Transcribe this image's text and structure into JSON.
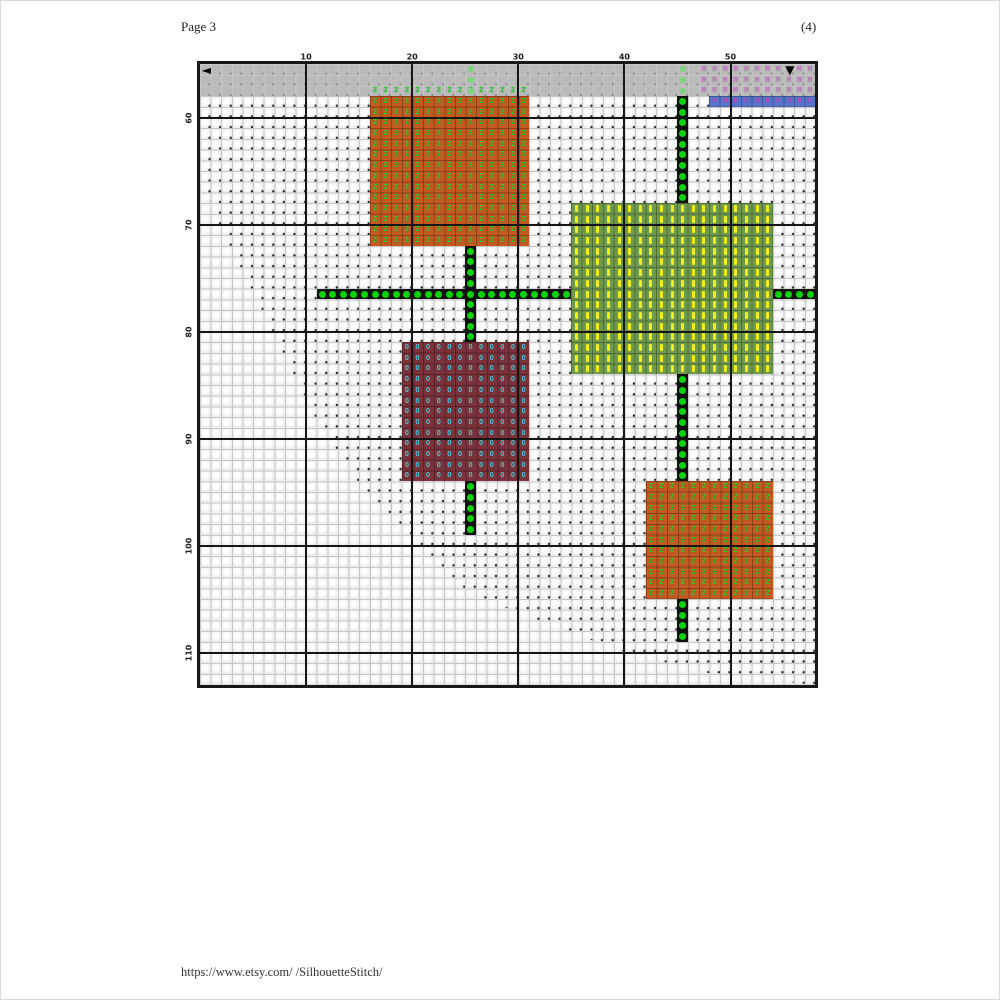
{
  "page": {
    "header_left": "Page 3",
    "header_right": "(4)",
    "footer_url": "https://www.etsy.com/ /SilhouetteStitch/"
  },
  "chart": {
    "type": "cross-stitch-grid",
    "geometry": {
      "x0": 199,
      "y0": 63,
      "cw": 10.61,
      "ch": 10.7,
      "cols": 58,
      "rows": 58
    },
    "colors": {
      "fine_line": "#c6c6c6",
      "heavy_line": "#161616",
      "cell_bg": "#fbfbfb",
      "cell_edge": "#ececec",
      "bg_dot": "#2a2a2a",
      "gray_band": "#bababa",
      "gray_band_dot": "#8d8d8d",
      "green_dot": "#0cd20c",
      "green_dot_bg": "#101010",
      "green_dot_grayed": "#79d879",
      "orange_bg": "#c25a22",
      "orange_symbol": "#2bd02b",
      "yellow_bg": "#6f9a4e",
      "yellow_symbol": "#f0ee1c",
      "maroon_bg": "#7b323a",
      "maroon_symbol": "#55c8d8",
      "blue_band_bg": "#5575cd",
      "magenta_symbol": "#c44fc4",
      "pink_symbol": "#d077d0",
      "block_grid_line": "rgba(0,0,0,0.28)"
    },
    "top_labels": [
      {
        "text": "10",
        "col": 10
      },
      {
        "text": "20",
        "col": 20
      },
      {
        "text": "30",
        "col": 30
      },
      {
        "text": "40",
        "col": 40
      },
      {
        "text": "50",
        "col": 50
      }
    ],
    "left_labels": [
      {
        "text": "60",
        "row": 5
      },
      {
        "text": "70",
        "row": 15
      },
      {
        "text": "80",
        "row": 25
      },
      {
        "text": "90",
        "row": 35
      },
      {
        "text": "100",
        "row": 45
      },
      {
        "text": "110",
        "row": 55
      }
    ],
    "gray_band": {
      "row": 0,
      "rows": 3
    },
    "blue_band": {
      "name": "blue-stitch-band",
      "col": 48,
      "row": 3,
      "cols": 10,
      "rows": 1,
      "symbol": "M"
    },
    "pink_overlap": {
      "name": "pink-overlap-symbols",
      "col": 47,
      "row": 0,
      "cols": 11,
      "rows": 3,
      "symbol": "M"
    },
    "blocks": [
      {
        "name": "orange-block-top-grayed-row",
        "col": 16,
        "row": 2,
        "cols": 15,
        "rows": 1,
        "bg": "none",
        "symbol": "Z",
        "symbol_color_key": "orange_symbol"
      },
      {
        "name": "orange-block-top",
        "col": 16,
        "row": 3,
        "cols": 15,
        "rows": 14,
        "bg_key": "orange_bg",
        "symbol": "Z",
        "symbol_color_key": "orange_symbol"
      },
      {
        "name": "yellow-block",
        "col": 35,
        "row": 13,
        "cols": 19,
        "rows": 16,
        "bg_key": "yellow_bg",
        "symbol": "bar",
        "symbol_color_key": "yellow_symbol"
      },
      {
        "name": "maroon-block",
        "col": 19,
        "row": 26,
        "cols": 12,
        "rows": 13,
        "bg_key": "maroon_bg",
        "symbol": "O",
        "symbol_color_key": "maroon_symbol"
      },
      {
        "name": "orange-block-bottom",
        "col": 42,
        "row": 39,
        "cols": 12,
        "rows": 11,
        "bg_key": "orange_bg",
        "symbol": "Z",
        "symbol_color_key": "orange_symbol"
      }
    ],
    "green_dot_segments": [
      {
        "dir": "v",
        "col": 25,
        "row": 0,
        "count": 3,
        "grayed": true
      },
      {
        "dir": "v",
        "col": 25,
        "row": 17,
        "count": 9
      },
      {
        "dir": "v",
        "col": 25,
        "row": 39,
        "count": 5
      },
      {
        "dir": "v",
        "col": 45,
        "row": 0,
        "count": 3,
        "grayed": true
      },
      {
        "dir": "v",
        "col": 45,
        "row": 3,
        "count": 10
      },
      {
        "dir": "v",
        "col": 45,
        "row": 29,
        "count": 10
      },
      {
        "dir": "v",
        "col": 45,
        "row": 50,
        "count": 4
      },
      {
        "dir": "h",
        "col": 11,
        "row": 21,
        "count": 24
      },
      {
        "dir": "h",
        "col": 54,
        "row": 21,
        "count": 4
      }
    ],
    "stitched_area_polygon": [
      [
        0,
        0
      ],
      [
        616,
        0
      ],
      [
        616,
        621
      ],
      [
        508,
        609
      ],
      [
        460,
        597
      ],
      [
        415,
        585
      ],
      [
        264,
        528
      ],
      [
        160,
        421
      ],
      [
        114,
        352
      ],
      [
        51,
        227
      ],
      [
        29,
        182
      ],
      [
        22,
        170
      ],
      [
        0,
        110
      ]
    ],
    "markers": {
      "left_arrow": {
        "glyph": "◄",
        "col": 0,
        "row": 0
      },
      "down_arrow": {
        "glyph": "▼",
        "col": 55,
        "row": 0
      }
    }
  }
}
